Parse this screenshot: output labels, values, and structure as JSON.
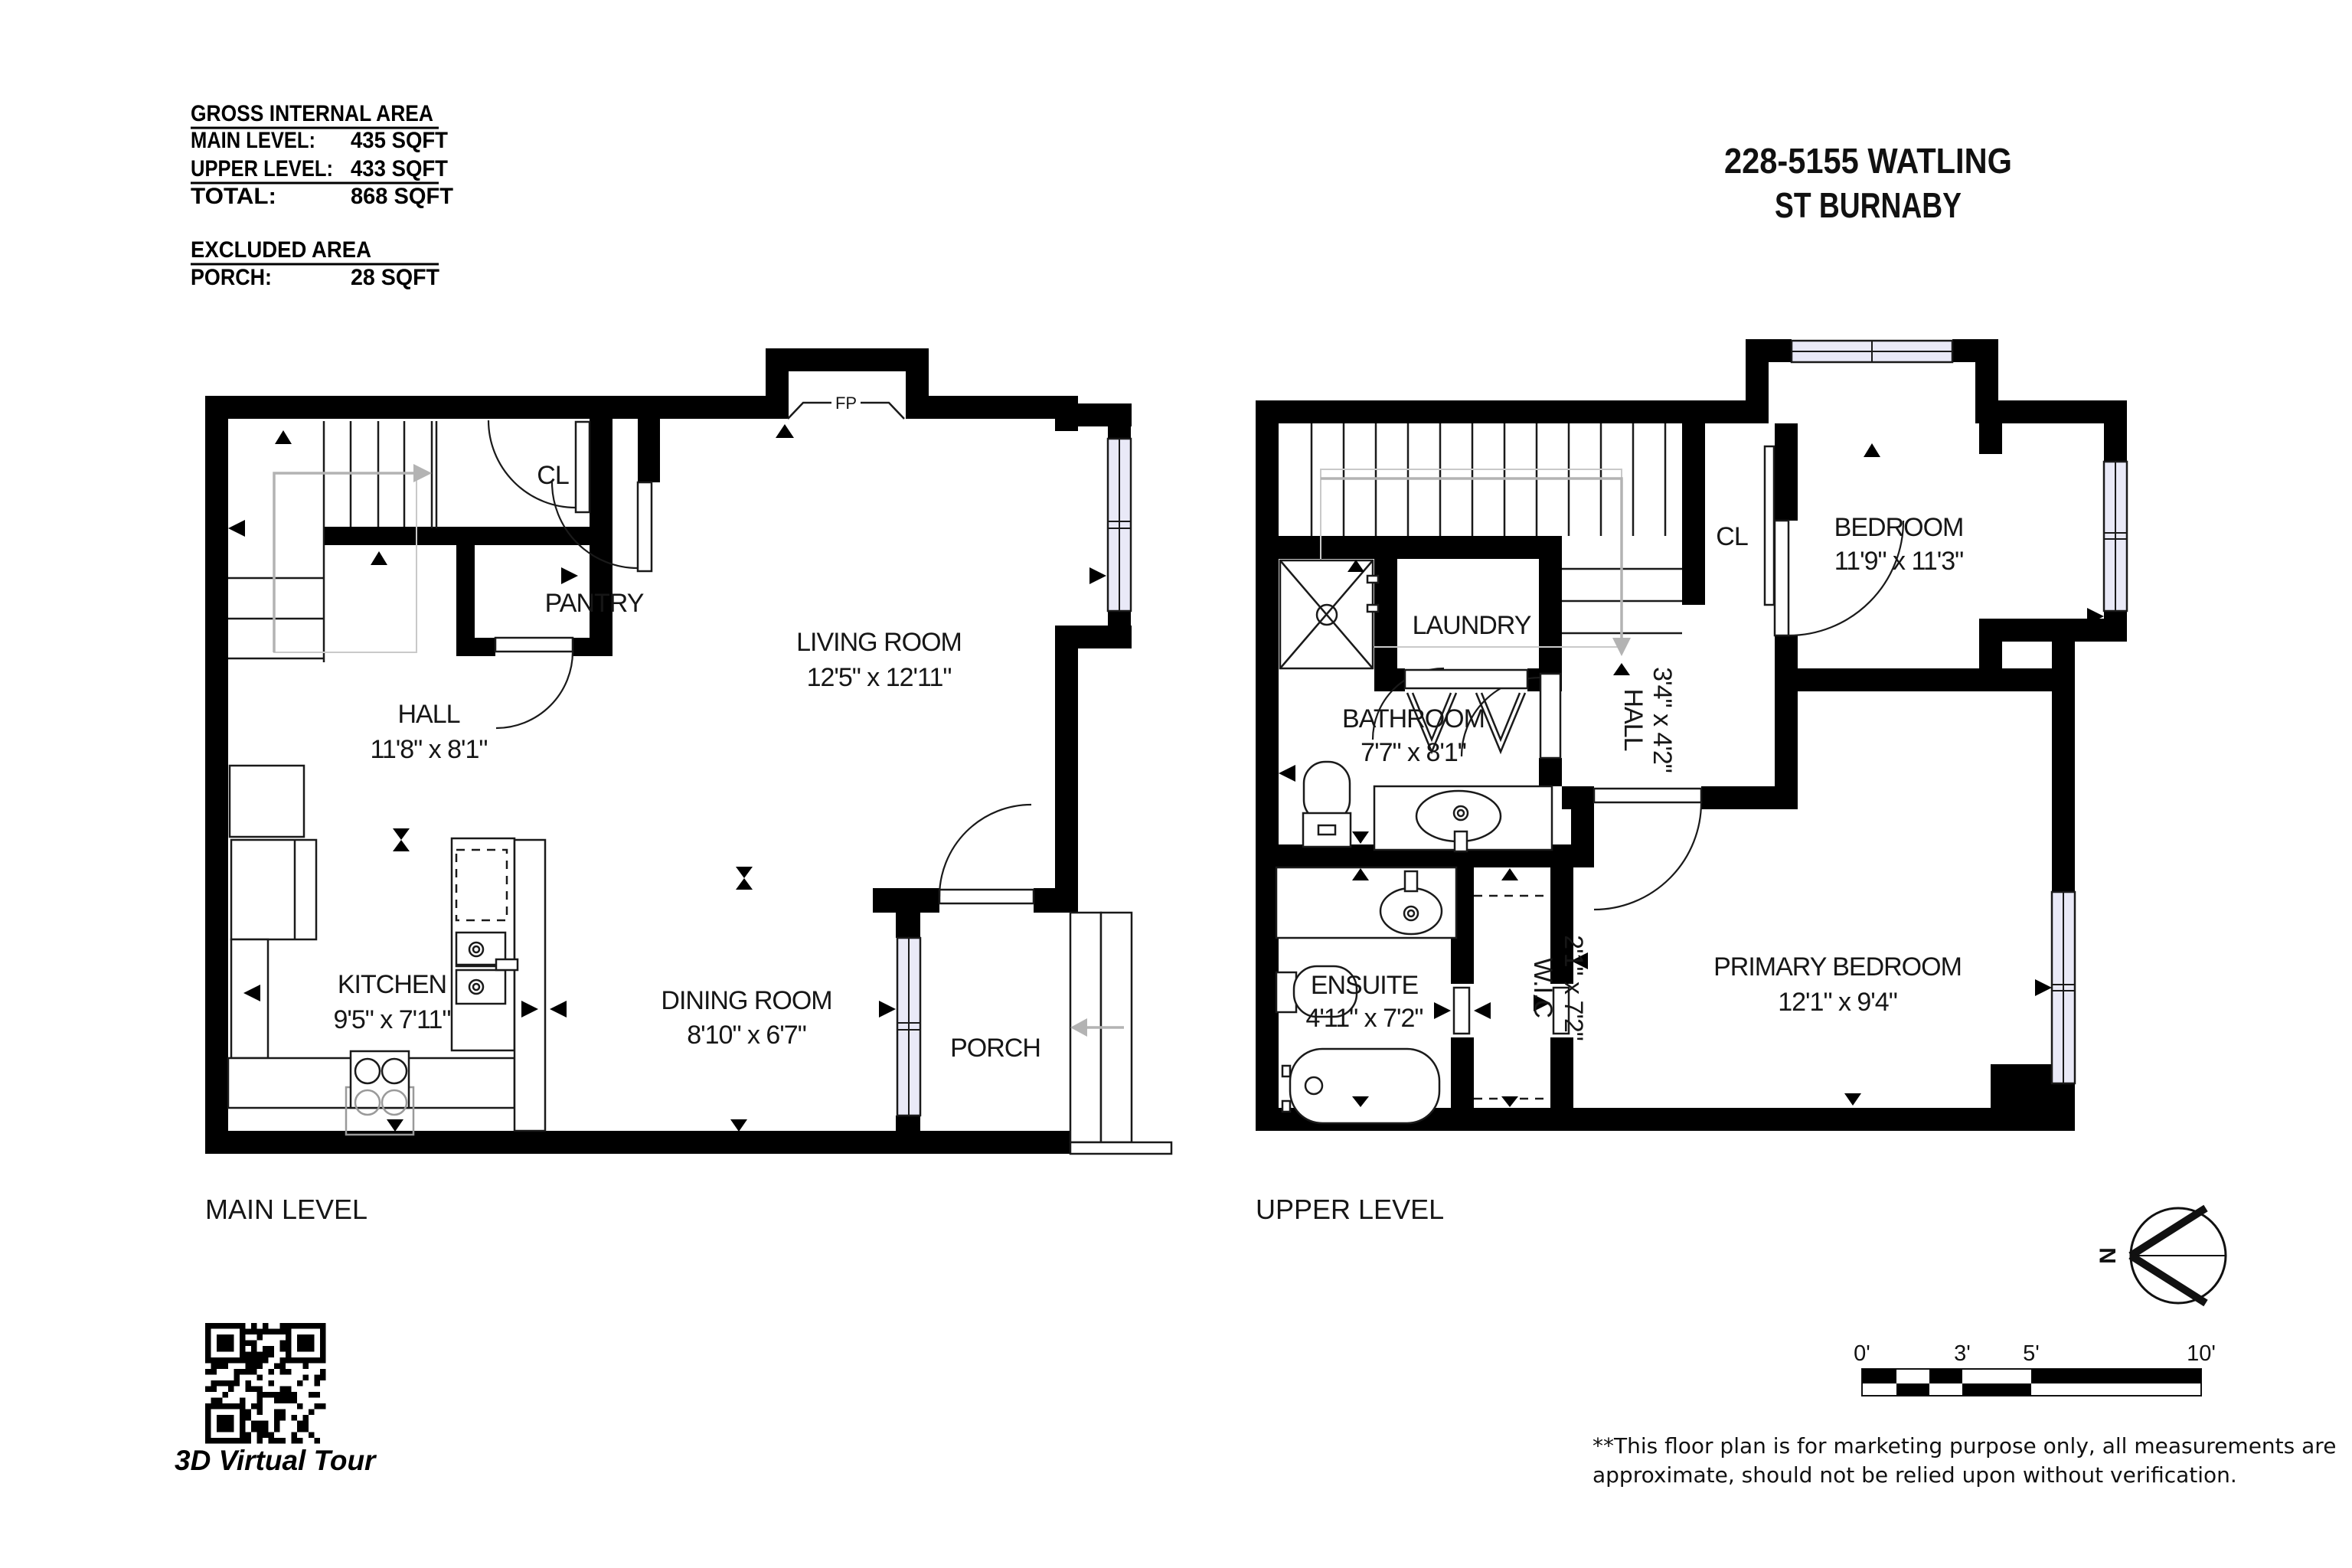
{
  "title": {
    "line1": "228-5155 WATLING",
    "line2": "ST BURNABY"
  },
  "area_summary": {
    "gross_title": "GROSS INTERNAL AREA",
    "main_label": "MAIN LEVEL:",
    "main_value": "435 SQFT",
    "upper_label": "UPPER LEVEL:",
    "upper_value": "433 SQFT",
    "total_label": "TOTAL:",
    "total_value": "868 SQFT",
    "excluded_title": "EXCLUDED AREA",
    "porch_label": "PORCH:",
    "porch_value": "28 SQFT"
  },
  "main_level": {
    "name": "MAIN LEVEL",
    "cl": "CL",
    "pantry": "PANTRY",
    "fireplace": "FP",
    "living": {
      "label": "LIVING ROOM",
      "dims": "12'5\" x 12'11\""
    },
    "hall": {
      "label": "HALL",
      "dims": "11'8\" x 8'1\""
    },
    "kitchen": {
      "label": "KITCHEN",
      "dims": "9'5\" x 7'11\""
    },
    "dining": {
      "label": "DINING ROOM",
      "dims": "8'10\" x 6'7\""
    },
    "porch": {
      "label": "PORCH"
    }
  },
  "upper_level": {
    "name": "UPPER LEVEL",
    "cl": "CL",
    "laundry": "LAUNDRY",
    "bedroom": {
      "label": "BEDROOM",
      "dims": "11'9\" x 11'3\""
    },
    "bathroom": {
      "label": "BATHROOM",
      "dims": "7'7\" x 8'1\""
    },
    "hall": {
      "label": "HALL",
      "dims": "3'4\" x 4'2\""
    },
    "ensuite": {
      "label": "ENSUITE",
      "dims": "4'11\" x 7'2\""
    },
    "wic": {
      "label": "W.I.C",
      "dims": "2'1\" x 7'2\""
    },
    "primary": {
      "label": "PRIMARY BEDROOM",
      "dims": "12'1\" x 9'4\""
    }
  },
  "qr_caption": "3D Virtual Tour",
  "compass_north": "N",
  "scale_bar": {
    "t0": "0'",
    "t3": "3'",
    "t5": "5'",
    "t10": "10'"
  },
  "disclaimer": {
    "line1": "**This floor plan is for marketing purpose only, all measurements are",
    "line2": "approximate, should not be relied upon without verification."
  }
}
